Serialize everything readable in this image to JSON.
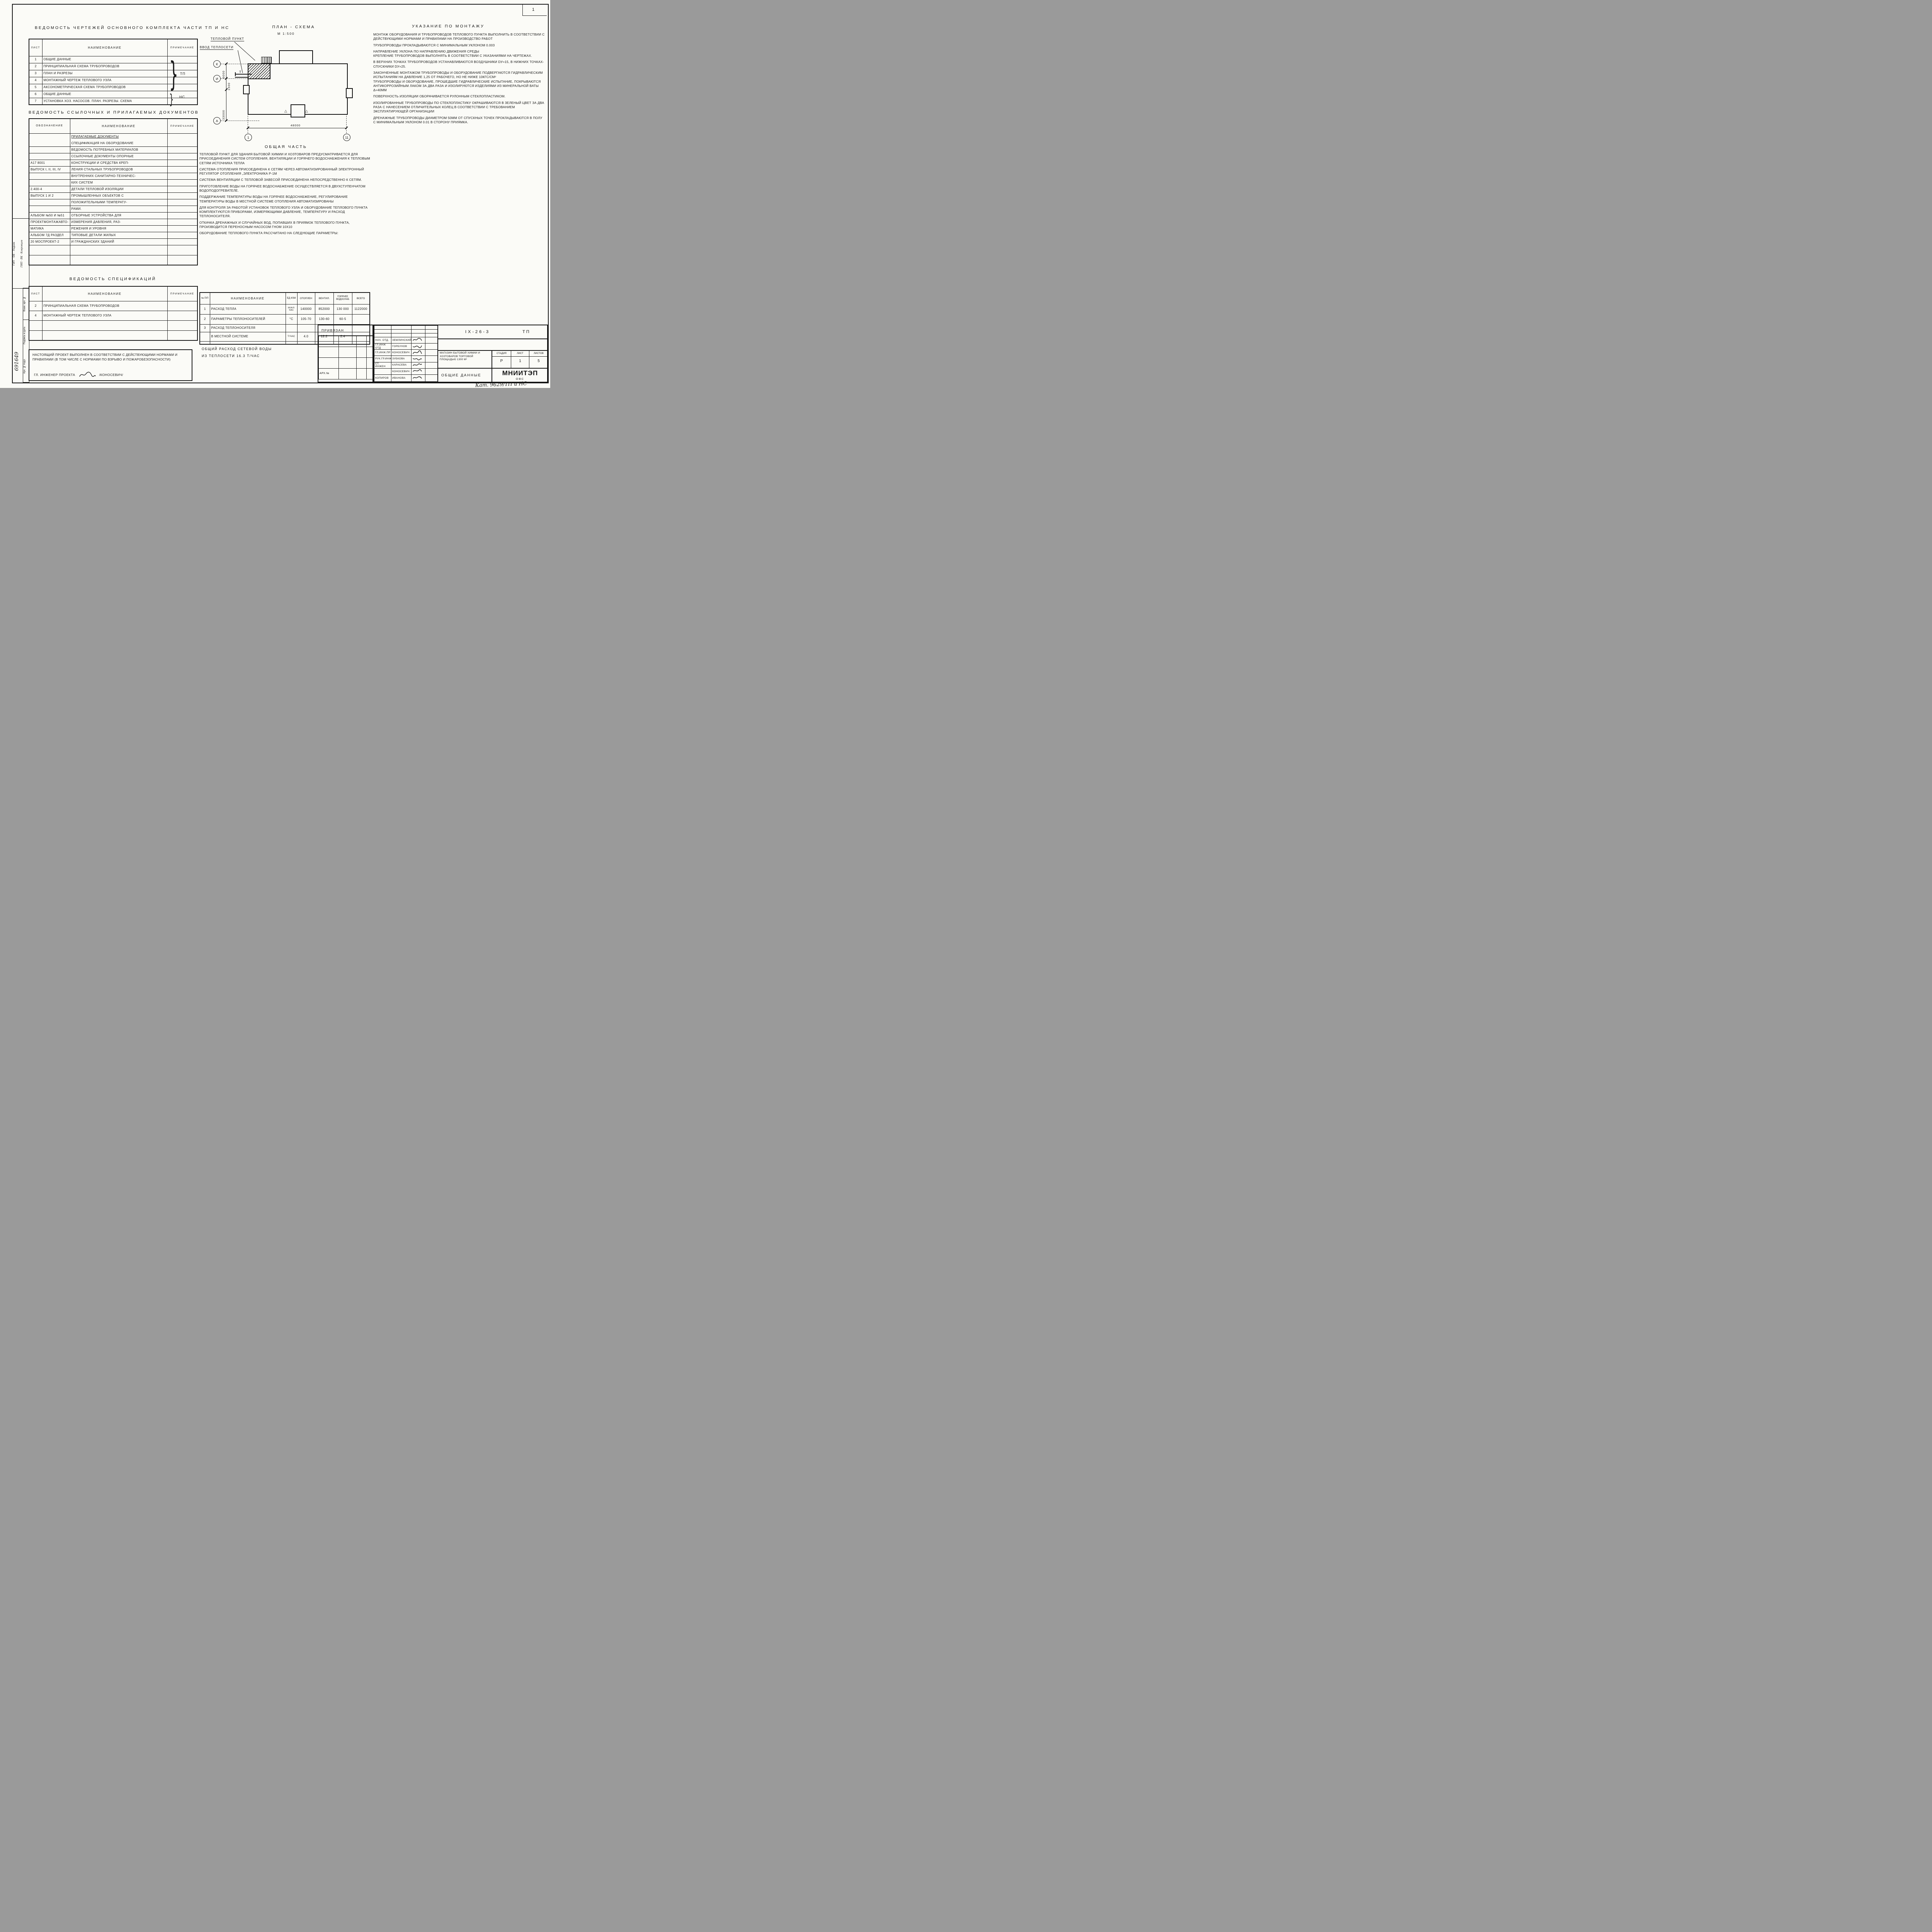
{
  "sheet": {
    "corner_number": "1",
    "catalog_note": "Кат. 9629/ТП и НС"
  },
  "tables": {
    "sheets": {
      "title": "Ведомость чертежей основного комплекта части ТП и НС",
      "headers": {
        "list": "Лист",
        "name": "Наименование",
        "note": "Примечание"
      },
      "brace_glyph": "}",
      "brace_tp_label": "ТП",
      "brace_ns_label": "НС",
      "rows": [
        {
          "n": "1",
          "name": "Общие данные"
        },
        {
          "n": "2",
          "name": "Принципиальная схема трубопроводов"
        },
        {
          "n": "3",
          "name": "План и разрезы"
        },
        {
          "n": "4",
          "name": "Монтажный чертеж теплового узла"
        },
        {
          "n": "5",
          "name": "Аксонометрическая схема трубопроводов"
        },
        {
          "n": "6",
          "name": "Общие данные"
        },
        {
          "n": "7",
          "name": "Установка хоз. насосов. План. Разрезы. Схема"
        }
      ]
    },
    "refs": {
      "title": "Ведомость ссылочных и прилагаемых документов",
      "headers": {
        "code": "Обозначение",
        "name": "Наименование",
        "note": "Примечание"
      },
      "rows": [
        {
          "c": "",
          "n": "Прилагаемые документы"
        },
        {
          "c": "",
          "n": "Спецификация на оборудование"
        },
        {
          "c": "",
          "n": "Ведомость потребных материалов"
        },
        {
          "c": "",
          "n": "Ссылочные документы Опорные"
        },
        {
          "c": "А17 8001",
          "n": "конструкции и средства креп-"
        },
        {
          "c": "Выпуск I, II, III, IV",
          "n": "ления стальных трубопроводов"
        },
        {
          "c": "",
          "n": "внутренних санитарно-техничес-"
        },
        {
          "c": "",
          "n": "ких систем"
        },
        {
          "c": "2.400-4",
          "n": "Детали тепловой изоляции"
        },
        {
          "c": "Выпуск 1 и 2",
          "n": "промышленных объектов с"
        },
        {
          "c": "",
          "n": "положительными температу-"
        },
        {
          "c": "",
          "n": "рами."
        },
        {
          "c": "Альбом №50 и №51",
          "n": "Отборные устройства для"
        },
        {
          "c": "Проектмонтажавто-",
          "n": "измерения давления, раз-"
        },
        {
          "c": "матика",
          "n": "режения и уровня"
        },
        {
          "c": "Альбом 7д раздел",
          "n": "Типовые детали жилых"
        },
        {
          "c": "20 Моспроект-2",
          "n": "и гражданских зданий"
        },
        {
          "c": "",
          "n": ""
        },
        {
          "c": "",
          "n": ""
        }
      ]
    },
    "specs": {
      "title": "Ведомость спецификаций",
      "headers": {
        "list": "Лист",
        "name": "Наименование",
        "note": "Примечание"
      },
      "rows": [
        {
          "n": "2",
          "name": "Принципиальная схема трубопроводов"
        },
        {
          "n": "4",
          "name": "Монтажный чертеж теплового узла"
        },
        {
          "n": "",
          "name": ""
        },
        {
          "n": "",
          "name": ""
        }
      ]
    }
  },
  "plan": {
    "title": "План - схема",
    "scale": "М 1:500",
    "label_tp": "Тепловой пункт",
    "label_vvod": "Ввод теплосети",
    "t_mark": "Т",
    "tri_glyph": "△",
    "dims": {
      "d6000": "6000",
      "d1500": "1500",
      "d33000": "33000",
      "d48000": "48000"
    },
    "axes": {
      "k": "К",
      "i": "И",
      "a": "А",
      "one": "1",
      "eleven": "11"
    }
  },
  "obshchaya": {
    "title": "Общая часть",
    "paragraphs": [
      "Тепловой пункт для здания бытовой химии и хозтоваров предусматривается для присоединения систем отопления, вентиляции и горячего водоснабжения к тепловым сетям источника тепла",
      "Система отопления присоединена к сетям через автоматизированный электронный регулятор отопления „Электроника Р-1М",
      "Система вентиляции с тепловой завесой присоединена непосредственно к сетям.",
      "Приготовление воды на горячее водоснабжение осуществляется в двухступенчатом водоподогревателе.",
      "Поддержание температуры воды на горячее водоснабжение, регулирование температуры воды в местной системе отопления автоматизированы",
      "Для контроля за работой установок теплового узла и оборудование теплового пункта комплектуются приборами, измеряющими давление, температуру и расход теплоносителя.",
      "Откачка дренажных и случайных вод, попавших в приямок теплового пункта, производится переносным насосом ГНОМ 10х10",
      "Оборудование теплового пункта рассчитано на следующие параметры:"
    ]
  },
  "params": {
    "headers": {
      "num": "№ п/п",
      "name": "Наименование",
      "unit": "Ед изм",
      "heat": "Отоплен",
      "vent": "Вентил.",
      "hw": "Горячее водоснаб",
      "total": "Всего"
    },
    "rows": [
      {
        "num": "1",
        "name": "Расход тепла",
        "unit": "ккал/час",
        "heat": "140000",
        "vent": "852000",
        "hw": "130 000",
        "total": "1122000"
      },
      {
        "num": "2",
        "name": "Параметры теплоносителей",
        "unit": "°С",
        "heat": "105-70",
        "vent": "130-60",
        "hw": "60-5",
        "total": ""
      },
      {
        "num": "3",
        "name": "Расход теплоносителя",
        "unit": "",
        "heat": "",
        "vent": "",
        "hw": "",
        "total": ""
      },
      {
        "num": "",
        "name": "в местной системе",
        "unit": "Т/час",
        "heat": "4.0",
        "vent": "12.2",
        "hw": "2.4",
        "total": ""
      }
    ],
    "total_note_line1": "Общий расход сетевой воды",
    "total_note_line2": "из теплосети 16.3 Т/час"
  },
  "ukazaniya": {
    "title": "Указание по монтажу",
    "paragraphs": [
      "Монтаж оборудования и трубопроводов теплового пункта выполнить в соответствии с действующими нормами и правилами на производство работ",
      "Трубопроводы прокладываются с минимальным уклоном 0.003",
      "Направление уклона по направлению движения среды",
      "Крепление трубопроводов выполнять в соответствии с указаниями на чертежах.",
      "В верхних точках трубопроводов устанавливаются воздушники dу=15, в нижних точках-спускники dу=25.",
      "Законченные монтажом трубопроводы и оборудование подвергаются гидравлическим испытаниям на давление 1,25 от рабочего, но не ниже 10кгс/см²",
      "Трубопроводы и оборудование, прошедшие гидравлические испытание, покрываются антикоррозийным лаком за два раза и изолируются изделиями из минеральной ваты δ=40мм",
      "Поверхность изоляции оборачивается рулонным стеклопластиком.",
      "Изолированные трубопроводы по стеклопластику окрашиваются в зеленый цвет за два раза с нанесением отличительных колец в соответствии с требованием эксплуатирующей организации",
      "Дренажные трубопроводы диаметром 50мм от спускных точек прокладываются в полу с минимальным уклоном 0.01 в сторону приямка."
    ]
  },
  "note_box": {
    "text": "Настоящий проект выполнен в соответствии с действующими нормами и правилами (в том числе с нормами по взрыво и пожаробезопасности)",
    "signer_role": "Гл. инженер проекта",
    "signer_name": "/Коносевич/"
  },
  "titleblock": {
    "code": "IX-26-3",
    "part": "ТП",
    "privyazan": "Привязан",
    "arh_no": "Арх.№",
    "project": "Магазин бытовой химии и хозтоваров торговой площадью 1300 м²",
    "doc_title": "Общие данные",
    "org": "МНИИТЭП",
    "dept": "ОВС",
    "stage_h": "Стадия",
    "sheet_h": "Лист",
    "sheets_h": "Листов",
    "stage": "Р",
    "sheet": "1",
    "sheets": "5",
    "roles": [
      {
        "role": "Нач. отд.",
        "name": "Землинский"
      },
      {
        "role": "Гл.инж отд",
        "name": "Горбунов"
      },
      {
        "role": "Гл.инж.пр",
        "name": "Коносевич"
      },
      {
        "role": "Рук.гр.инж",
        "name": "Зубкова"
      },
      {
        "role": "Ст. инжен",
        "name": "Карасева"
      },
      {
        "role": "",
        "name": "Коносевич"
      },
      {
        "role": "Копиров",
        "name": "Иванова"
      }
    ]
  },
  "margin": {
    "stamp_col1": "ГИП · ОВ · Ледник",
    "stamp_col2": "ГИП · ВК · Ковровцев",
    "strip_top": "Взам. арх. №",
    "strip_mid": "Подпись и дата",
    "strip_bot": "Арх. № подл.",
    "inv_number": "691649"
  }
}
